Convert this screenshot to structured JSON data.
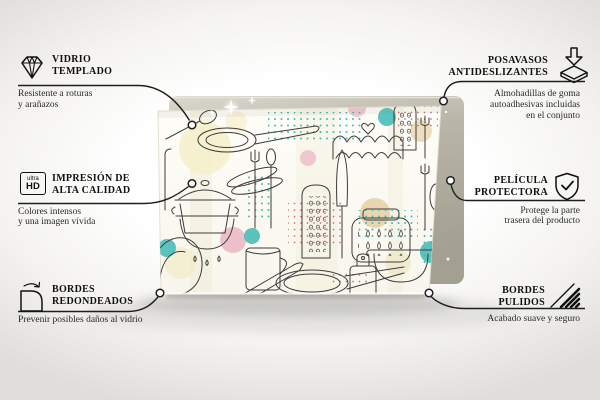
{
  "product": {
    "type": "glass board with kitchen utensil doodle print",
    "pattern_motifs": [
      "frying-pan",
      "stock-pot",
      "saucepan",
      "grater",
      "mug",
      "fork",
      "spoon",
      "slotted-spoon",
      "tongs",
      "kitchen-jar",
      "colander",
      "knife",
      "spatula",
      "cutting-board",
      "ladle",
      "scallop-waves",
      "heart",
      "polka-dot-grids",
      "pastel-circles"
    ],
    "colors": {
      "teal": "#49bcb8",
      "pink": "#eab6c4",
      "cream": "#f4eec9",
      "tan": "#e6cfa6",
      "red_dots": "#c2556a",
      "line_art": "#3c3c3c",
      "glass_face": "#fdfcf6",
      "backing_panel": "#b6b2a5"
    }
  },
  "features": {
    "left": [
      {
        "id": "vidrio-templado",
        "icon": "diamond-icon",
        "title_lines": [
          "VIDRIO",
          "TEMPLADO"
        ],
        "description_lines": [
          "Resistente a roturas",
          "y arañazos"
        ]
      },
      {
        "id": "impresion-alta-calidad",
        "icon": "ultra-hd-icon",
        "title_lines": [
          "IMPRESIÓN DE",
          "ALTA CALIDAD"
        ],
        "description_lines": [
          "Colores intensos",
          "y una imagen vívida"
        ]
      },
      {
        "id": "bordes-redondeados",
        "icon": "rounded-corner-icon",
        "title_lines": [
          "BORDES",
          "REDONDEADOS"
        ],
        "description_lines": [
          "Prevenir posibles daños al vidrio"
        ]
      }
    ],
    "right": [
      {
        "id": "posavasos-antideslizantes",
        "icon": "non-slip-pad-icon",
        "title_lines": [
          "POSAVASOS",
          "ANTIDESLIZANTES"
        ],
        "description_lines": [
          "Almohadillas de goma",
          "autoadhesivas incluidas",
          "en el conjunto"
        ]
      },
      {
        "id": "pelicula-protectora",
        "icon": "shield-check-icon",
        "title_lines": [
          "PELÍCULA",
          "PROTECTORA"
        ],
        "description_lines": [
          "Protege la parte",
          "trasera del producto"
        ]
      },
      {
        "id": "bordes-pulidos",
        "icon": "polished-edge-icon",
        "title_lines": [
          "BORDES",
          "PULIDOS"
        ],
        "description_lines": [
          "Acabado suave y seguro"
        ]
      }
    ]
  },
  "icons": {
    "hd_top": "ultra",
    "hd_bottom": "HD"
  }
}
